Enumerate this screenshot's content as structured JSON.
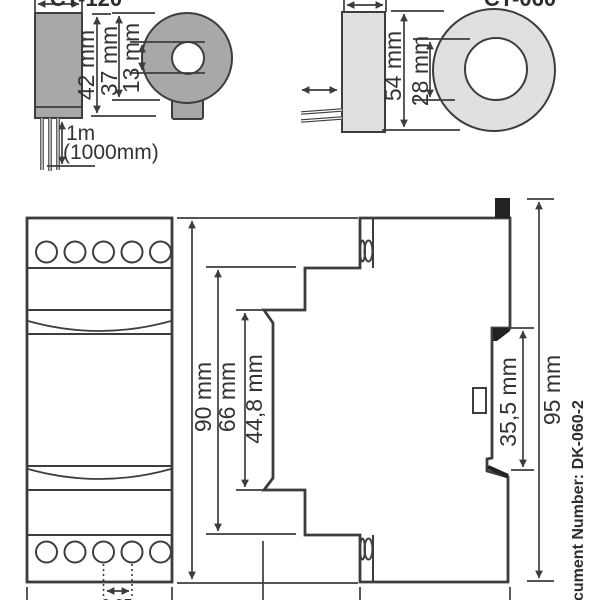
{
  "ct120": {
    "label": "CT-120",
    "dim_total_height": "42 mm",
    "dim_outer_diameter": "37 mm",
    "dim_hole_diameter": "13 mm",
    "cable_length": "1m",
    "cable_length_alt": "(1000mm)"
  },
  "ct060": {
    "label": "CT-060",
    "dim_outer_diameter": "54 mm",
    "dim_hole_diameter": "28 mm"
  },
  "module_front": {
    "dim_height": "90 mm",
    "dim_body_height": "66 mm",
    "dim_window_height": "44,8 mm",
    "dim_terminal_pitch": "9,95"
  },
  "module_side": {
    "dim_rail_recess": "35,5 mm",
    "dim_total_height": "95 mm"
  },
  "footer": {
    "document_number": "cument Number: DK-060-2"
  },
  "colors": {
    "ct120_fill": "#a8a8a8",
    "ct060_fill": "#e0e0e0",
    "line": "#3d3d3d"
  }
}
